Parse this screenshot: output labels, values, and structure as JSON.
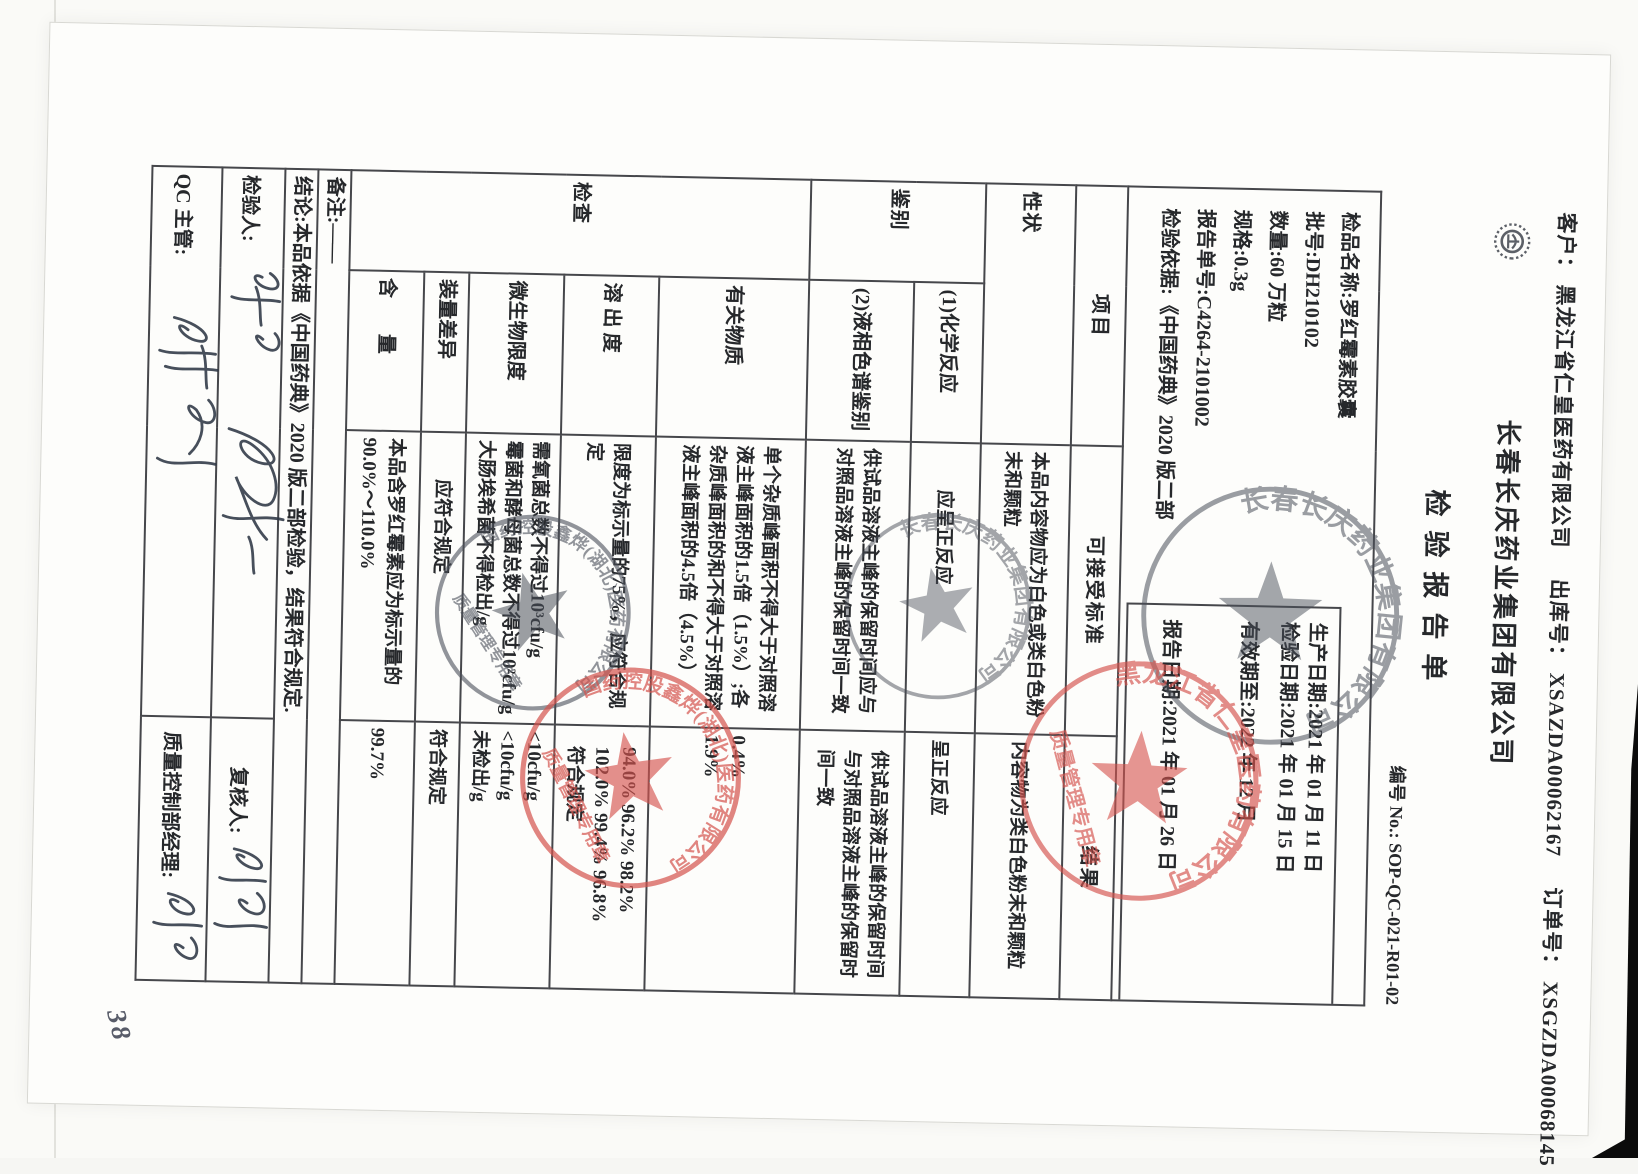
{
  "header": {
    "customer_label": "客户：",
    "customer": "黑龙江省仁皇医药有限公司",
    "outbound_label": "出库号：",
    "outbound_no": "XSAZDA00062167",
    "order_label": "订单号：",
    "order_no": "XSGZDA00068145",
    "company": "长春长庆药业集团有限公司",
    "report_title": "检验报告单",
    "doc_no_label": "编号 No.:",
    "doc_no": "SOP-QC-021-R01-02",
    "logo_name": "company-emblem"
  },
  "info": {
    "left_lines": [
      "检品名称:罗红霉素胶囊",
      "批号:DH210102",
      "数量:60 万粒",
      "规格:0.3g",
      "报告单号:C4264-2101002",
      "检验依据:《中国药典》2020 版二部"
    ],
    "dates": [
      "生产日期:2021 年 01 月 11 日",
      "检验日期:2021 年 01 月 15 日",
      "有效期至:2022 年 12 月",
      "报告日期:2021 年 01 月 26 日"
    ]
  },
  "table": {
    "col_headers": {
      "item": "项目",
      "standard": "可接受标准",
      "result": "结果"
    },
    "xingzhuang": {
      "label": "性状",
      "standard": "本品内容物应为白色或类白色粉末和颗粒",
      "result": "内容物为类白色粉末和颗粒"
    },
    "jianbie": {
      "label": "鉴别",
      "sub1": {
        "name": "(1)化学反应",
        "standard": "应呈正反应",
        "result": "呈正反应"
      },
      "sub2": {
        "name": "(2)液相色谱鉴别",
        "standard": "供试品溶液主峰的保留时间应与对照品溶液主峰的保留时间一致",
        "result": "供试品溶液主峰的保留时间与对照品溶液主峰的保留时间一致"
      }
    },
    "jiancha": {
      "label": "检查",
      "items": [
        {
          "name": "有关物质",
          "standard": "单个杂质峰面积不得大于对照溶液主峰面积的1.5倍（1.5%）;各杂质峰面积的和不得大于对照溶液主峰面积的4.5倍（4.5%）",
          "result": "0.4%\n1.9%"
        },
        {
          "name": "溶 出 度",
          "standard": "限度为标示量的75%，应符合规定",
          "result": "94.0% 96.2% 98.2%\n102.0% 99.4% 96.8%\n符合规定"
        },
        {
          "name": "微生物限度",
          "standard": "需氧菌总数不得过10³cfu/g\n霉菌和酵母菌总数不得过10²cfu/g\n大肠埃希菌不得检出/g",
          "result": "<10cfu/g\n<10cfu/g\n未检出/g"
        },
        {
          "name": "装量差异",
          "standard": "应符合规定",
          "result": "符合规定"
        },
        {
          "name": "含　量",
          "standard": "本品含罗红霉素应为标示量的90.0%～110.0%",
          "result": "99.7%"
        }
      ]
    },
    "remark": "备注:——",
    "conclusion": "结论:本品依据《中国药典》2020 版二部检验，结果符合规定.",
    "signatures": {
      "inspector_label": "检验人:",
      "reviewer_label": "复核人:",
      "qc_label": "QC 主管:",
      "manager_label": "质量控制部经理:"
    }
  },
  "stamps": {
    "changqing_top": {
      "ring": "长春长庆药业集团有限公司",
      "color": "#4b505a"
    },
    "changqing_mid": {
      "ring": "长春长庆药业集团有限公司",
      "color": "#4b505a"
    },
    "renhuang": {
      "ring": "黑龙江省仁皇医药有限公司",
      "inner": "质量管理专用章",
      "color": "#d5534d"
    },
    "sinopharm_gray": {
      "ring": "国药控股鑫烨(湖北)医药有限公司",
      "inner": "质量管理专用章",
      "color": "#4b505a"
    },
    "sinopharm_red": {
      "ring": "国药控股鑫烨(湖北)医药有限公司",
      "inner": "质量管理专用章",
      "color": "#d5534d"
    }
  },
  "page_mark": "38"
}
